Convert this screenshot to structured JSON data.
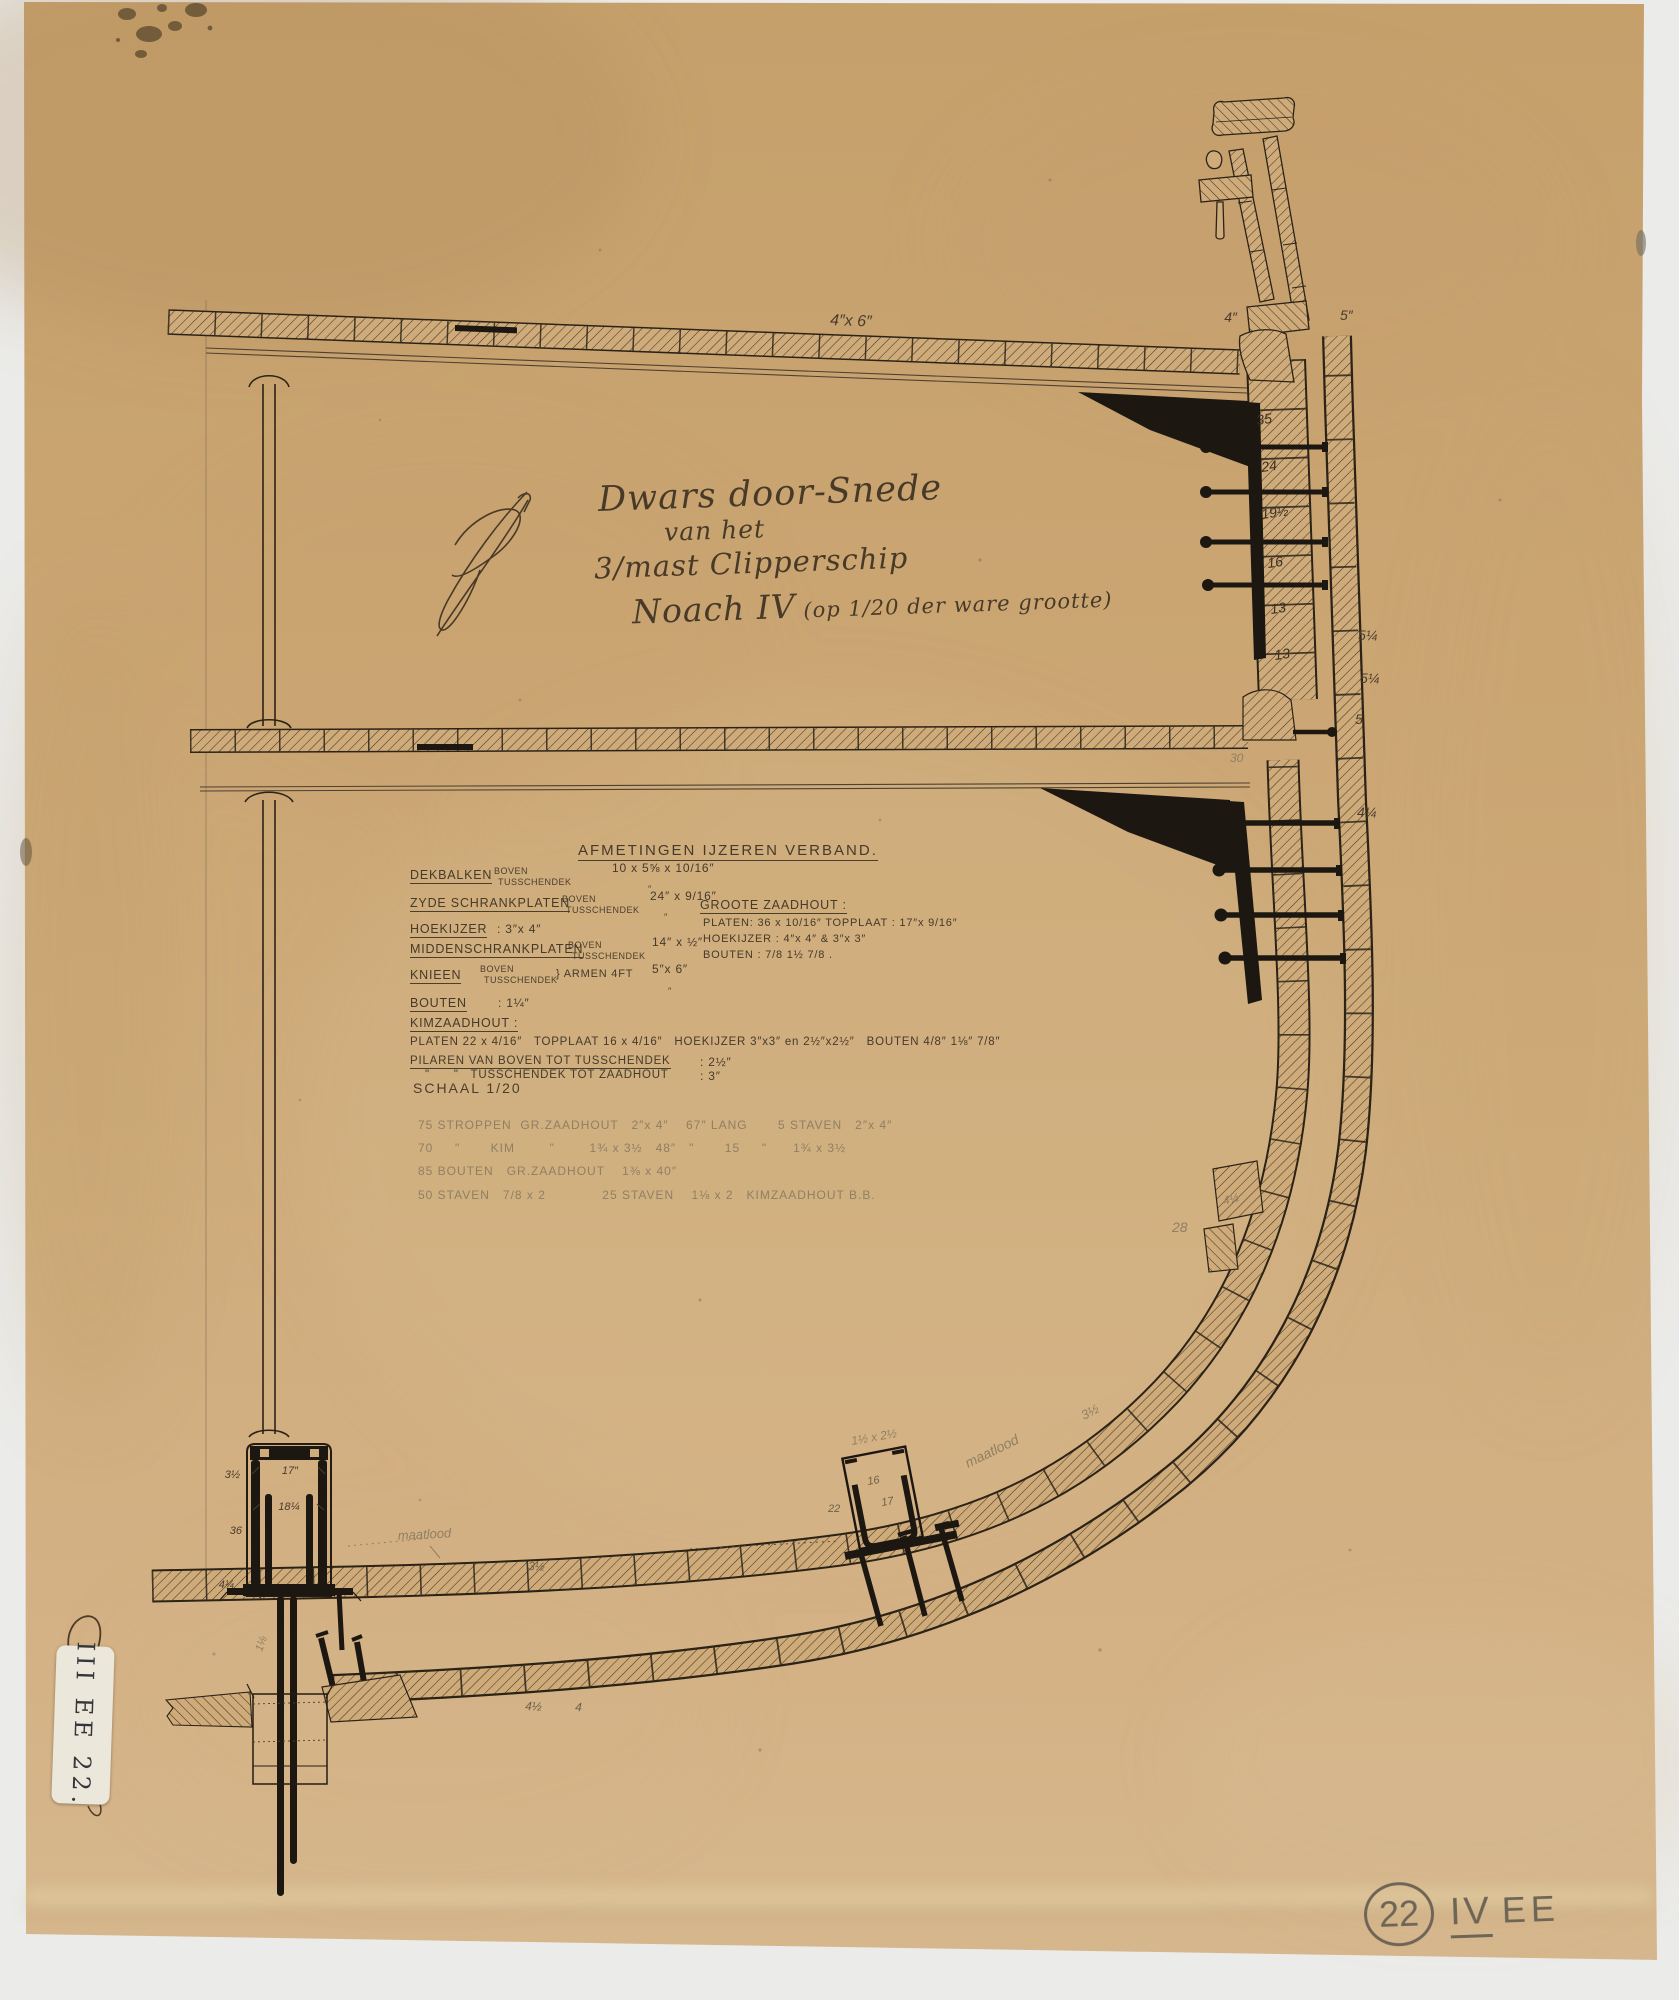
{
  "title_block": {
    "line1": "Dwars door-Snede",
    "line2": "van het",
    "line3": "3/mast Clipperschip",
    "line4_name": "Noach IV",
    "line4_rest": "(op 1/20 der ware grootte)"
  },
  "afmetingen": {
    "heading": "AFMETINGEN IJZEREN VERBAND.",
    "ditto": "″",
    "rows": [
      {
        "label": "DEKBALKEN",
        "sub1": "BOVEN",
        "sub2": "TUSSCHENDEK",
        "value": "10 x 5⅝ x 10/16″"
      },
      {
        "label": "ZYDE SCHRANKPLATEN",
        "sub1": "BOVEN",
        "sub2": "TUSSCHENDEK",
        "value": "24″ x 9/16″"
      },
      {
        "label": "HOEKIJZER",
        "value": ": 3″x 4″"
      },
      {
        "label": "MIDDENSCHRANKPLATEN",
        "sub1": "BOVEN",
        "sub2": "TUSSCHENDEK",
        "value": "14″ x ½″"
      },
      {
        "label": "KNIEEN",
        "sub1": "BOVEN",
        "sub2": "TUSSCHENDEK",
        "brace": "} ARMEN 4FT",
        "value": "5″x 6″"
      },
      {
        "label": "BOUTEN",
        "value": ": 1¼″"
      },
      {
        "label": "KIMZAADHOUT :",
        "value": ""
      },
      {
        "label": "",
        "value": "PLATEN 22 x 4/16″   TOPPLAAT 16 x 4/16″   HOEKIJZER 3″x3″ en 2½″x2½″   BOUTEN 4/8″ 1⅛″ 7/8″"
      },
      {
        "label": "PILAREN VAN BOVEN TOT TUSSCHENDEK",
        "value": ": 2½″"
      },
      {
        "label": "\"      \"   TUSSCHENDEK TOT ZAADHOUT",
        "value": ": 3″"
      }
    ],
    "groote": {
      "heading": "GROOTE ZAADHOUT :",
      "line1": "PLATEN: 36 x 10/16″  TOPPLAAT : 17″x 9/16″",
      "line2": "HOEKIJZER : 4″x 4″ & 3″x 3″",
      "line3": "BOUTEN : 7/8   1½   7/8 ."
    }
  },
  "schaal": {
    "label": "SCHAAL 1/20",
    "lines": [
      "75 STROPPEN  GR.ZAADHOUT   2″x 4″    67″ LANG       5 STAVEN   2″x 4″",
      "70     \"       KIM        \"        1¾ x 3½   48″   \"       15     \"      1¾ x 3½",
      "85 BOUTEN   GR.ZAADHOUT    1⅜ x 40″",
      "50 STAVEN   7/8 x 2             25 STAVEN    1⅛ x 2   KIMZAADHOUT B.B."
    ]
  },
  "marks": {
    "deck_planks": "4″x 6″",
    "deck_edge_in": "4″",
    "deck_edge_out": "5″",
    "frames": [
      "35",
      "24",
      "19½",
      "16",
      "13",
      "13"
    ],
    "shell": [
      "5¼",
      "5¼",
      "5",
      "4¼"
    ],
    "tween_width": "30",
    "bilge_pencil": "28",
    "stringer": "4½",
    "band_pencil": "3½",
    "floor_inner": "3½",
    "floor_outer_a": "4½",
    "floor_outer_b": "4",
    "kim_angle": "1½ x 2½",
    "kim_plate": "16",
    "kim_top": "17",
    "kim_height": "22",
    "kim_maatlood": "maatlood",
    "keelson_side": "3½",
    "keelson_top": "17″",
    "keelson_inner": "18¼",
    "keelson_height": "36",
    "keelson_base": "4¼",
    "keelson_maatlood": "maatlood",
    "keel_bolt": "1⅛"
  },
  "sticker": {
    "text": "III EE 22."
  },
  "stamp": {
    "number": "22",
    "numeral": "IV",
    "letters": "EE"
  }
}
